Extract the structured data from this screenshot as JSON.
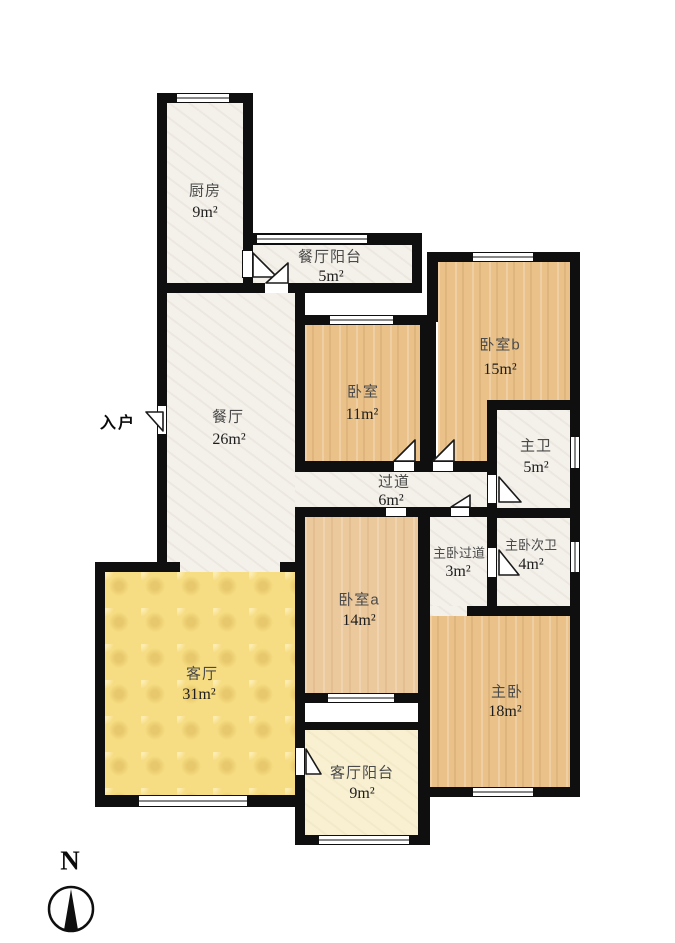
{
  "north_label": "N",
  "entrance_label": "入户",
  "rooms": {
    "kitchen": {
      "label": "厨房",
      "area": "9m²"
    },
    "dining_balcony": {
      "label": "餐厅阳台",
      "area": "5m²"
    },
    "bedroom_b": {
      "label": "卧室b",
      "area": "15m²"
    },
    "bedroom": {
      "label": "卧室",
      "area": "11m²"
    },
    "dining": {
      "label": "餐厅",
      "area": "26m²"
    },
    "master_bath": {
      "label": "主卫",
      "area": "5m²"
    },
    "hallway": {
      "label": "过道",
      "area": "6m²"
    },
    "master_hall": {
      "label": "主卧过道",
      "area": "3m²"
    },
    "master_second_bath": {
      "label": "主卧次卫",
      "area": "4m²"
    },
    "bedroom_a": {
      "label": "卧室a",
      "area": "14m²"
    },
    "living": {
      "label": "客厅",
      "area": "31m²"
    },
    "master": {
      "label": "主卧",
      "area": "18m²"
    },
    "living_balcony": {
      "label": "客厅阳台",
      "area": "9m²"
    }
  },
  "colors": {
    "wall": "#0f0f0f",
    "wood_floor": "#eac289",
    "living_floor": "#f6dc82",
    "balcony_floor": "#f8f0d1",
    "tile_floor": "#f4f1ea",
    "label_text": "#4a4a4a"
  }
}
